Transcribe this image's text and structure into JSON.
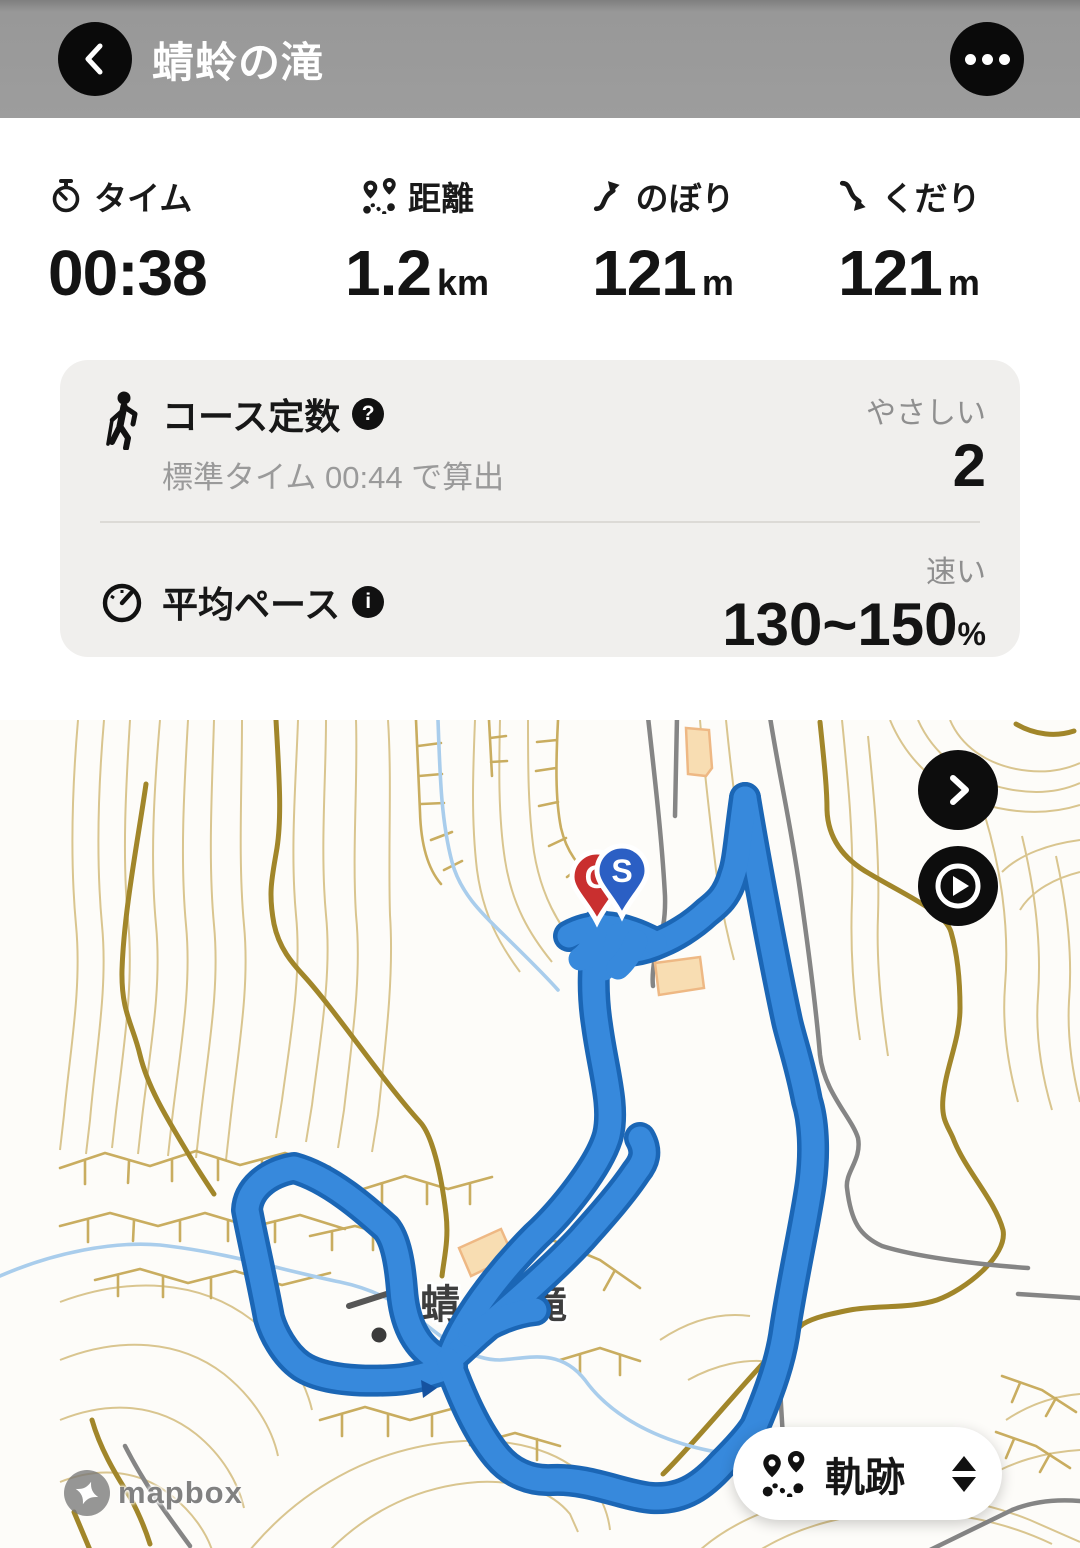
{
  "header": {
    "title": "蜻蛉の滝"
  },
  "stats": [
    {
      "icon": "stopwatch-icon",
      "label": "タイム",
      "value": "00:38",
      "unit": ""
    },
    {
      "icon": "route-icon",
      "label": "距離",
      "value": "1.2",
      "unit": "km"
    },
    {
      "icon": "ascent-icon",
      "label": "のぼり",
      "value": "121",
      "unit": "m"
    },
    {
      "icon": "descent-icon",
      "label": "くだり",
      "value": "121",
      "unit": "m"
    }
  ],
  "course": {
    "title": "コース定数",
    "help_glyph": "?",
    "subtitle": "標準タイム 00:44 で算出",
    "rating": "やさしい",
    "value": "2",
    "pace_title": "平均ペース",
    "info_glyph": "i",
    "pace_rating": "速い",
    "pace_value": "130~150",
    "pace_unit": "%"
  },
  "map": {
    "place_label_1": "蜻蛉",
    "place_label_2": "滝",
    "start_letter": "S",
    "goal_letter": "G",
    "track_button_label": "軌跡",
    "attribution": "mapbox",
    "colors": {
      "track": "#3789dc",
      "track_casing": "#1b66b5",
      "contour": "#d9c58f",
      "contour_index": "#a1862a",
      "cliff": "#c9ad60",
      "road": "#858585",
      "stream": "#a9cdec",
      "building_fill": "#f8ddb2",
      "building_stroke": "#eeb884",
      "goal_pin": "#c92f2f",
      "start_pin": "#2b5fc4"
    }
  }
}
